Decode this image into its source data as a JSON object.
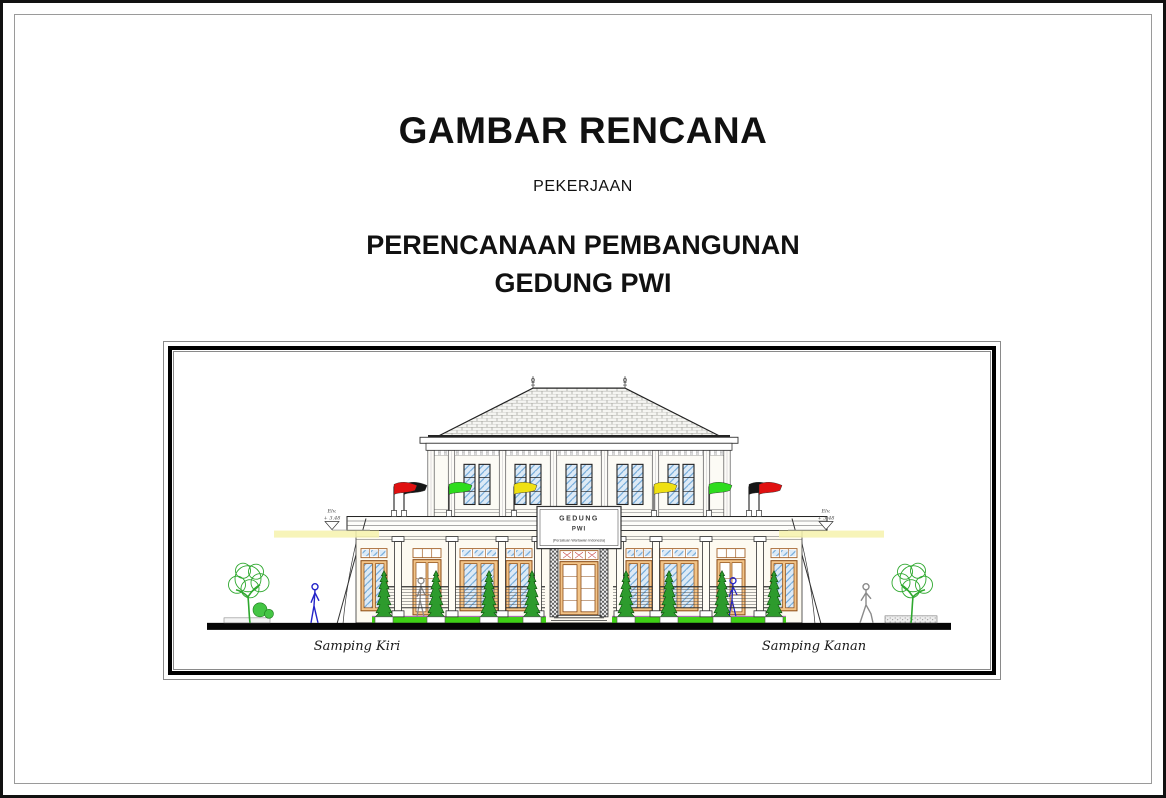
{
  "page": {
    "title": "GAMBAR RENCANA",
    "work_label": "PEKERJAAN",
    "project_line1": "PERENCANAAN PEMBANGUNAN",
    "project_line2": "GEDUNG PWI"
  },
  "drawing": {
    "view_label_left": "Samping Kiri",
    "view_label_right": "Samping Kanan",
    "elevation_marker": {
      "label": "Elv.",
      "value": "+ 3.48"
    },
    "building_sign": {
      "line1": "GEDUNG",
      "line2": "PWI",
      "line3": "(Persatuan Wartawan Indonesia)"
    },
    "flags_left_to_right": [
      "red",
      "black",
      "green",
      "yellow",
      "yellow",
      "green",
      "black",
      "red"
    ],
    "colors": {
      "flag_red": "#e01010",
      "flag_black": "#161616",
      "flag_green": "#2edc1e",
      "flag_yellow": "#efe012",
      "glass_blue": "#6fa8d8",
      "frame_tan": "#f2c488",
      "shrub_green": "#2d9b2d",
      "grass_green": "#3fd016",
      "tree_green": "#2ea82e",
      "highlight_yellow": "#f6f2ad",
      "figure_blue": "#2323c8",
      "figure_gray": "#8a8a8a"
    }
  }
}
